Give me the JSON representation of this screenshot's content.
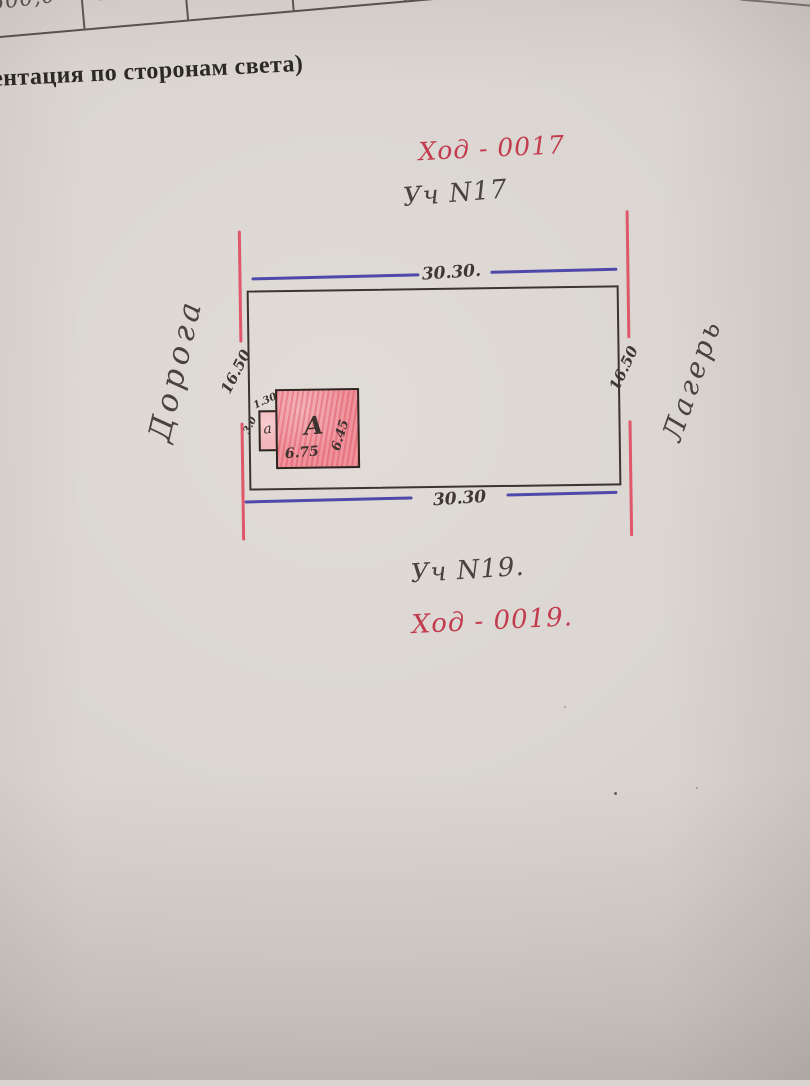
{
  "paper": {
    "table_cells": [
      "500,0",
      "500,0"
    ],
    "caption": "ентация по сторонам света)"
  },
  "plan": {
    "code_top": "Ход - 0017",
    "plot_top": "Уч N17",
    "dim_top": "30.30.",
    "dim_bottom": "30.30",
    "dim_left": "16.50",
    "dim_right": "16.50",
    "road_left": "Дорога",
    "side_right": "Лагерь",
    "building_label": "А",
    "building_width": "6.75",
    "building_depth": "6.45",
    "annex_label": "а",
    "annex_width": "1.30",
    "annex_depth": "3.0",
    "plot_bottom": "Уч N19.",
    "code_bottom": "Ход - 0019."
  },
  "colors": {
    "red_ink": "#c23b4e",
    "boundary_red": "#e0485f",
    "blue_ink": "#413da6",
    "pencil": "#48433d",
    "plot_border": "#3b352e",
    "building_fill": "#ef929b",
    "annex_fill": "#f2b5ba",
    "paper": "#d8d3ce"
  }
}
